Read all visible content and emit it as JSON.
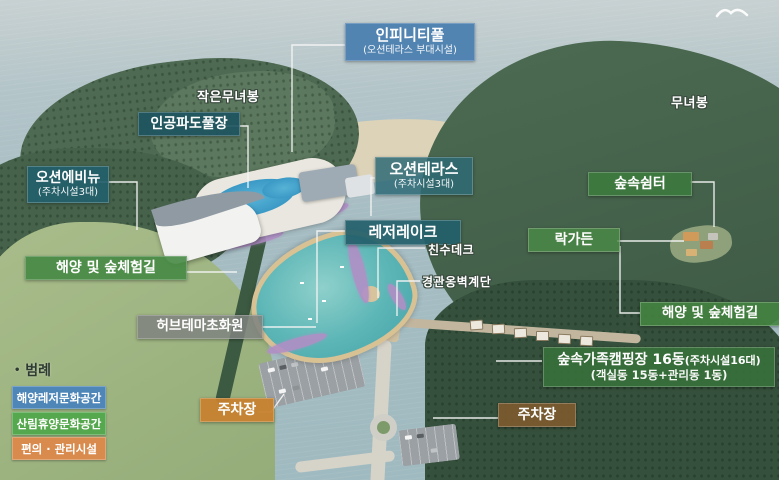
{
  "labels": {
    "infinity_pool": {
      "title": "인피니티풀",
      "sub": "(오션테라스 부대시설)",
      "color": "#4c7fb0"
    },
    "wave_pool": {
      "title": "인공파도풀장",
      "color": "#1e5561"
    },
    "ocean_avenue": {
      "title": "오션에비뉴",
      "sub": "(주차시설3대)",
      "color": "#235f6b"
    },
    "ocean_terrace": {
      "title": "오션테라스",
      "sub": "(주차시설3대)",
      "color": "#2e6a76"
    },
    "forest_shelter": {
      "title": "숲속쉼터",
      "color": "#3c7a3e"
    },
    "leisure_lake": {
      "title": "레저레이크",
      "color": "#235f6b"
    },
    "chinsu_deck": {
      "title": "친수데크"
    },
    "rock_garden": {
      "title": "락가든",
      "color": "#4a8a46"
    },
    "landscape_stairs": {
      "title": "경관옹벽계단"
    },
    "trail_left": {
      "title": "해양 및 숲체험길",
      "color": "#468a44"
    },
    "herb_garden": {
      "title": "허브테마초화원",
      "color": "#7f837f"
    },
    "trail_right": {
      "title": "해양 및 숲체험길",
      "color": "#44833f"
    },
    "camping": {
      "title": "숲속가족캠핑장 16동",
      "title_paren": "(주차시설16대)",
      "sub": "(객실동 15동+관리동 1동)",
      "color": "#37703a"
    },
    "parking_left": {
      "title": "주차장",
      "color": "#c8812f"
    },
    "parking_right": {
      "title": "주차장",
      "color": "#7d5a2e"
    },
    "peak_small": {
      "title": "작은무녀봉"
    },
    "peak_main": {
      "title": "무녀봉"
    }
  },
  "legend": {
    "bullet": "•",
    "title": "범례",
    "items": [
      {
        "label": "해양레저문화공간",
        "color": "#4e86b8"
      },
      {
        "label": "산림휴양문화공간",
        "color": "#55a84e"
      },
      {
        "label": "편의 · 관리시설",
        "color": "#d98a4d"
      }
    ]
  },
  "icons": {
    "seagull": "seagull-silhouette"
  }
}
